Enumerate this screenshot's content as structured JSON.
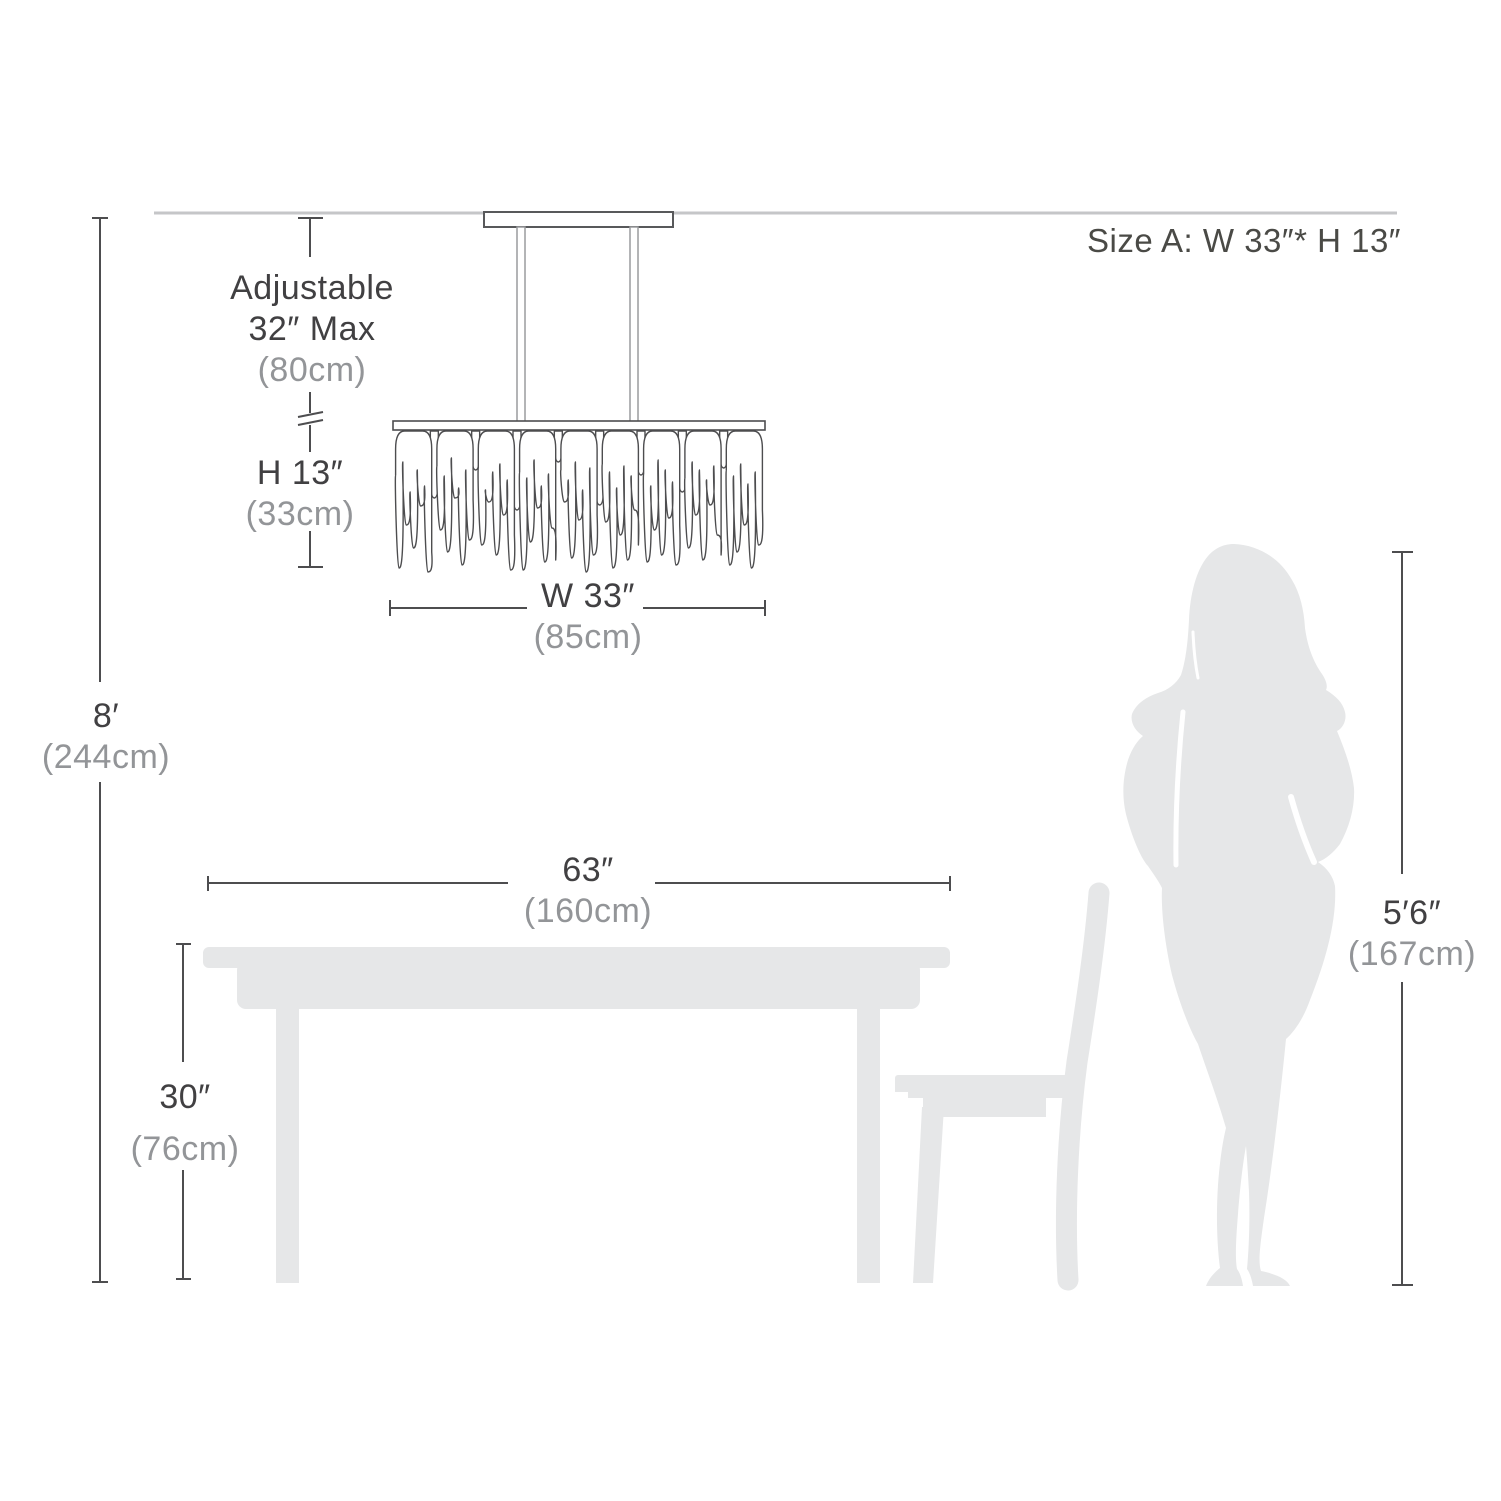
{
  "title": {
    "size_label": "Size A: W 33″* H 13″"
  },
  "chandelier": {
    "adjustable": {
      "line1": "Adjustable",
      "line2": "32″ Max",
      "metric": "(80cm)"
    },
    "height": {
      "imperial": "H 13″",
      "metric": "(33cm)"
    },
    "width": {
      "imperial": "W 33″",
      "metric": "(85cm)"
    }
  },
  "ceiling": {
    "height": {
      "imperial": "8′",
      "metric": "(244cm)"
    }
  },
  "table": {
    "width": {
      "imperial": "63″",
      "metric": "(160cm)"
    },
    "height": {
      "imperial": "30″",
      "metric": "(76cm)"
    }
  },
  "person": {
    "height": {
      "imperial": "5′6″",
      "metric": "(167cm)"
    }
  },
  "colors": {
    "text_dark": "#414042",
    "text_gray": "#939598",
    "silhouette": "#e6e7e8",
    "line_dark": "#4d4d4f",
    "ceiling_line": "#c5c6c8"
  }
}
